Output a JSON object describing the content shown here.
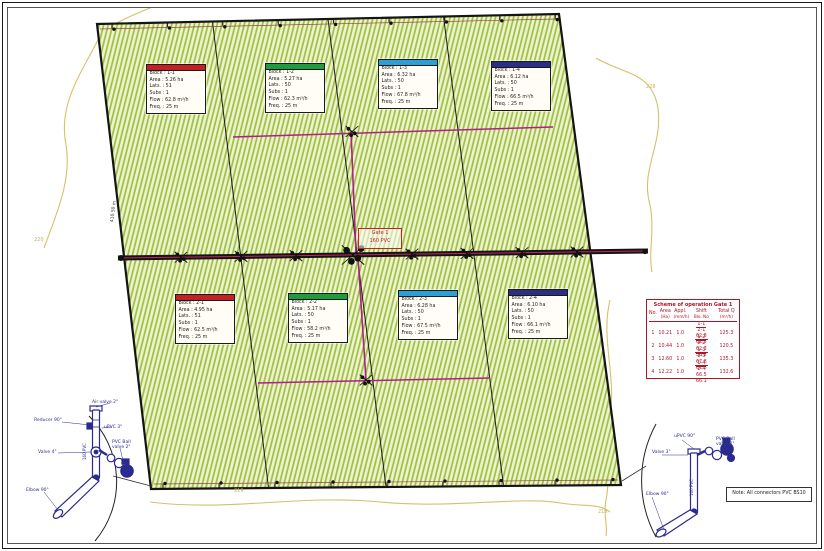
{
  "blocks": [
    {
      "header_style": "background:#c42127",
      "rows": [
        "Block : 1-1",
        "Area : 5.26 ha",
        "Lats. : 51",
        "Subs : 1",
        "Flow : 62.8 m³/h",
        "Freq. : 25 m"
      ]
    },
    {
      "header_style": "background:#1f9d3e",
      "rows": [
        "Block : 1-2",
        "Area : 5.27 ha",
        "Lats. : 50",
        "Subs : 1",
        "Flow : 62.3 m³/h",
        "Freq. : 25 m"
      ]
    },
    {
      "header_style": "background:#2e9fd4",
      "rows": [
        "Block : 1-3",
        "Area : 6.32 ha",
        "Lats. : 50",
        "Subs : 1",
        "Flow : 67.8 m³/h",
        "Freq. : 25 m"
      ]
    },
    {
      "header_style": "background:#2b2e83",
      "rows": [
        "Block : 1-4",
        "Area : 6.12 ha",
        "Lats. : 50",
        "Subs : 1",
        "Flow : 66.5 m³/h",
        "Freq. : 25 m"
      ]
    },
    {
      "header_style": "background:#c42127",
      "rows": [
        "Block : 2-1",
        "Area : 4.95 ha",
        "Lats. : 51",
        "Subs : 1",
        "Flow : 62.5 m³/h",
        "Freq. : 25 m"
      ]
    },
    {
      "header_style": "background:#1f9d3e",
      "rows": [
        "Block : 2-2",
        "Area : 5.17 ha",
        "Lats. : 50",
        "Subs : 1",
        "Flow : 58.2 m³/h",
        "Freq. : 25 m"
      ]
    },
    {
      "header_style": "background:#2e9fd4",
      "rows": [
        "Block : 2-3",
        "Area : 6.28 ha",
        "Lats. : 50",
        "Subs : 1",
        "Flow : 67.5 m³/h",
        "Freq. : 25 m"
      ]
    },
    {
      "header_style": "background:#2b2e83",
      "rows": [
        "Block : 2-4",
        "Area : 6.10 ha",
        "Lats. : 50",
        "Subs : 1",
        "Flow : 66.1 m³/h",
        "Freq. : 25 m"
      ]
    }
  ],
  "center_label": {
    "line1": "Gate 1",
    "line2": "160 PVC"
  },
  "table": {
    "title": "Scheme of operation  Gate 1",
    "columns": [
      {
        "l1": "No.",
        "l2": ""
      },
      {
        "l1": "Area",
        "l2": "(Ha)"
      },
      {
        "l1": "Appl.",
        "l2": "(mm/h)"
      },
      {
        "l1": "Shift",
        "l2": "Blo. No"
      },
      {
        "l1": "Total Q",
        "l2": "(m³/h)"
      }
    ],
    "rows": [
      {
        "no": "1",
        "area": "10.21",
        "appl": "1.0",
        "f1t": "1-1",
        "f1b": "2-1",
        "f2t": "62.8",
        "f2b": "62.5",
        "total": "125.3"
      },
      {
        "no": "2",
        "area": "10.44",
        "appl": "1.0",
        "f1t": "1-2",
        "f1b": "2-2",
        "f2t": "62.3",
        "f2b": "58.2",
        "total": "120.5"
      },
      {
        "no": "3",
        "area": "12.60",
        "appl": "1.0",
        "f1t": "1-3",
        "f1b": "2-3",
        "f2t": "67.8",
        "f2b": "67.5",
        "total": "135.3"
      },
      {
        "no": "4",
        "area": "12.22",
        "appl": "1.0",
        "f1t": "1-4",
        "f1b": "2-4",
        "f2t": "66.5",
        "f2b": "66.1",
        "total": "132.6"
      }
    ]
  },
  "note": "Note:  All connectors PVC BS10",
  "details": {
    "left": {
      "labels": {
        "air": "Air valve 2\"",
        "reducer": "Reducer 90°",
        "upvc": "uPVC 3\"",
        "ball": "PVC Ball valve 2\"",
        "valve": "Valve 4\"",
        "elbow": "Elbow 90°",
        "pipe": "160 PVC"
      }
    },
    "right": {
      "labels": {
        "upvc": "uPVC 90°",
        "ball": "PVC Ball valve 2\"",
        "valve": "Valve 3\"",
        "elbow": "Elbow 90°",
        "pipe": "160 PVC"
      }
    }
  },
  "contours": {
    "c1": "220",
    "c2": "228",
    "c3": "218",
    "c4": "219"
  },
  "dimensions": {
    "left_edge": "410.50 m"
  },
  "colors": {
    "field_stripe": "#9cbf3f",
    "field_bg": "#eef3cf",
    "manifold": "#b0208c",
    "main_red": "#c32566",
    "table_red": "#b01525",
    "detail_navy": "#2b2b8f",
    "contour": "#d6c06c"
  }
}
